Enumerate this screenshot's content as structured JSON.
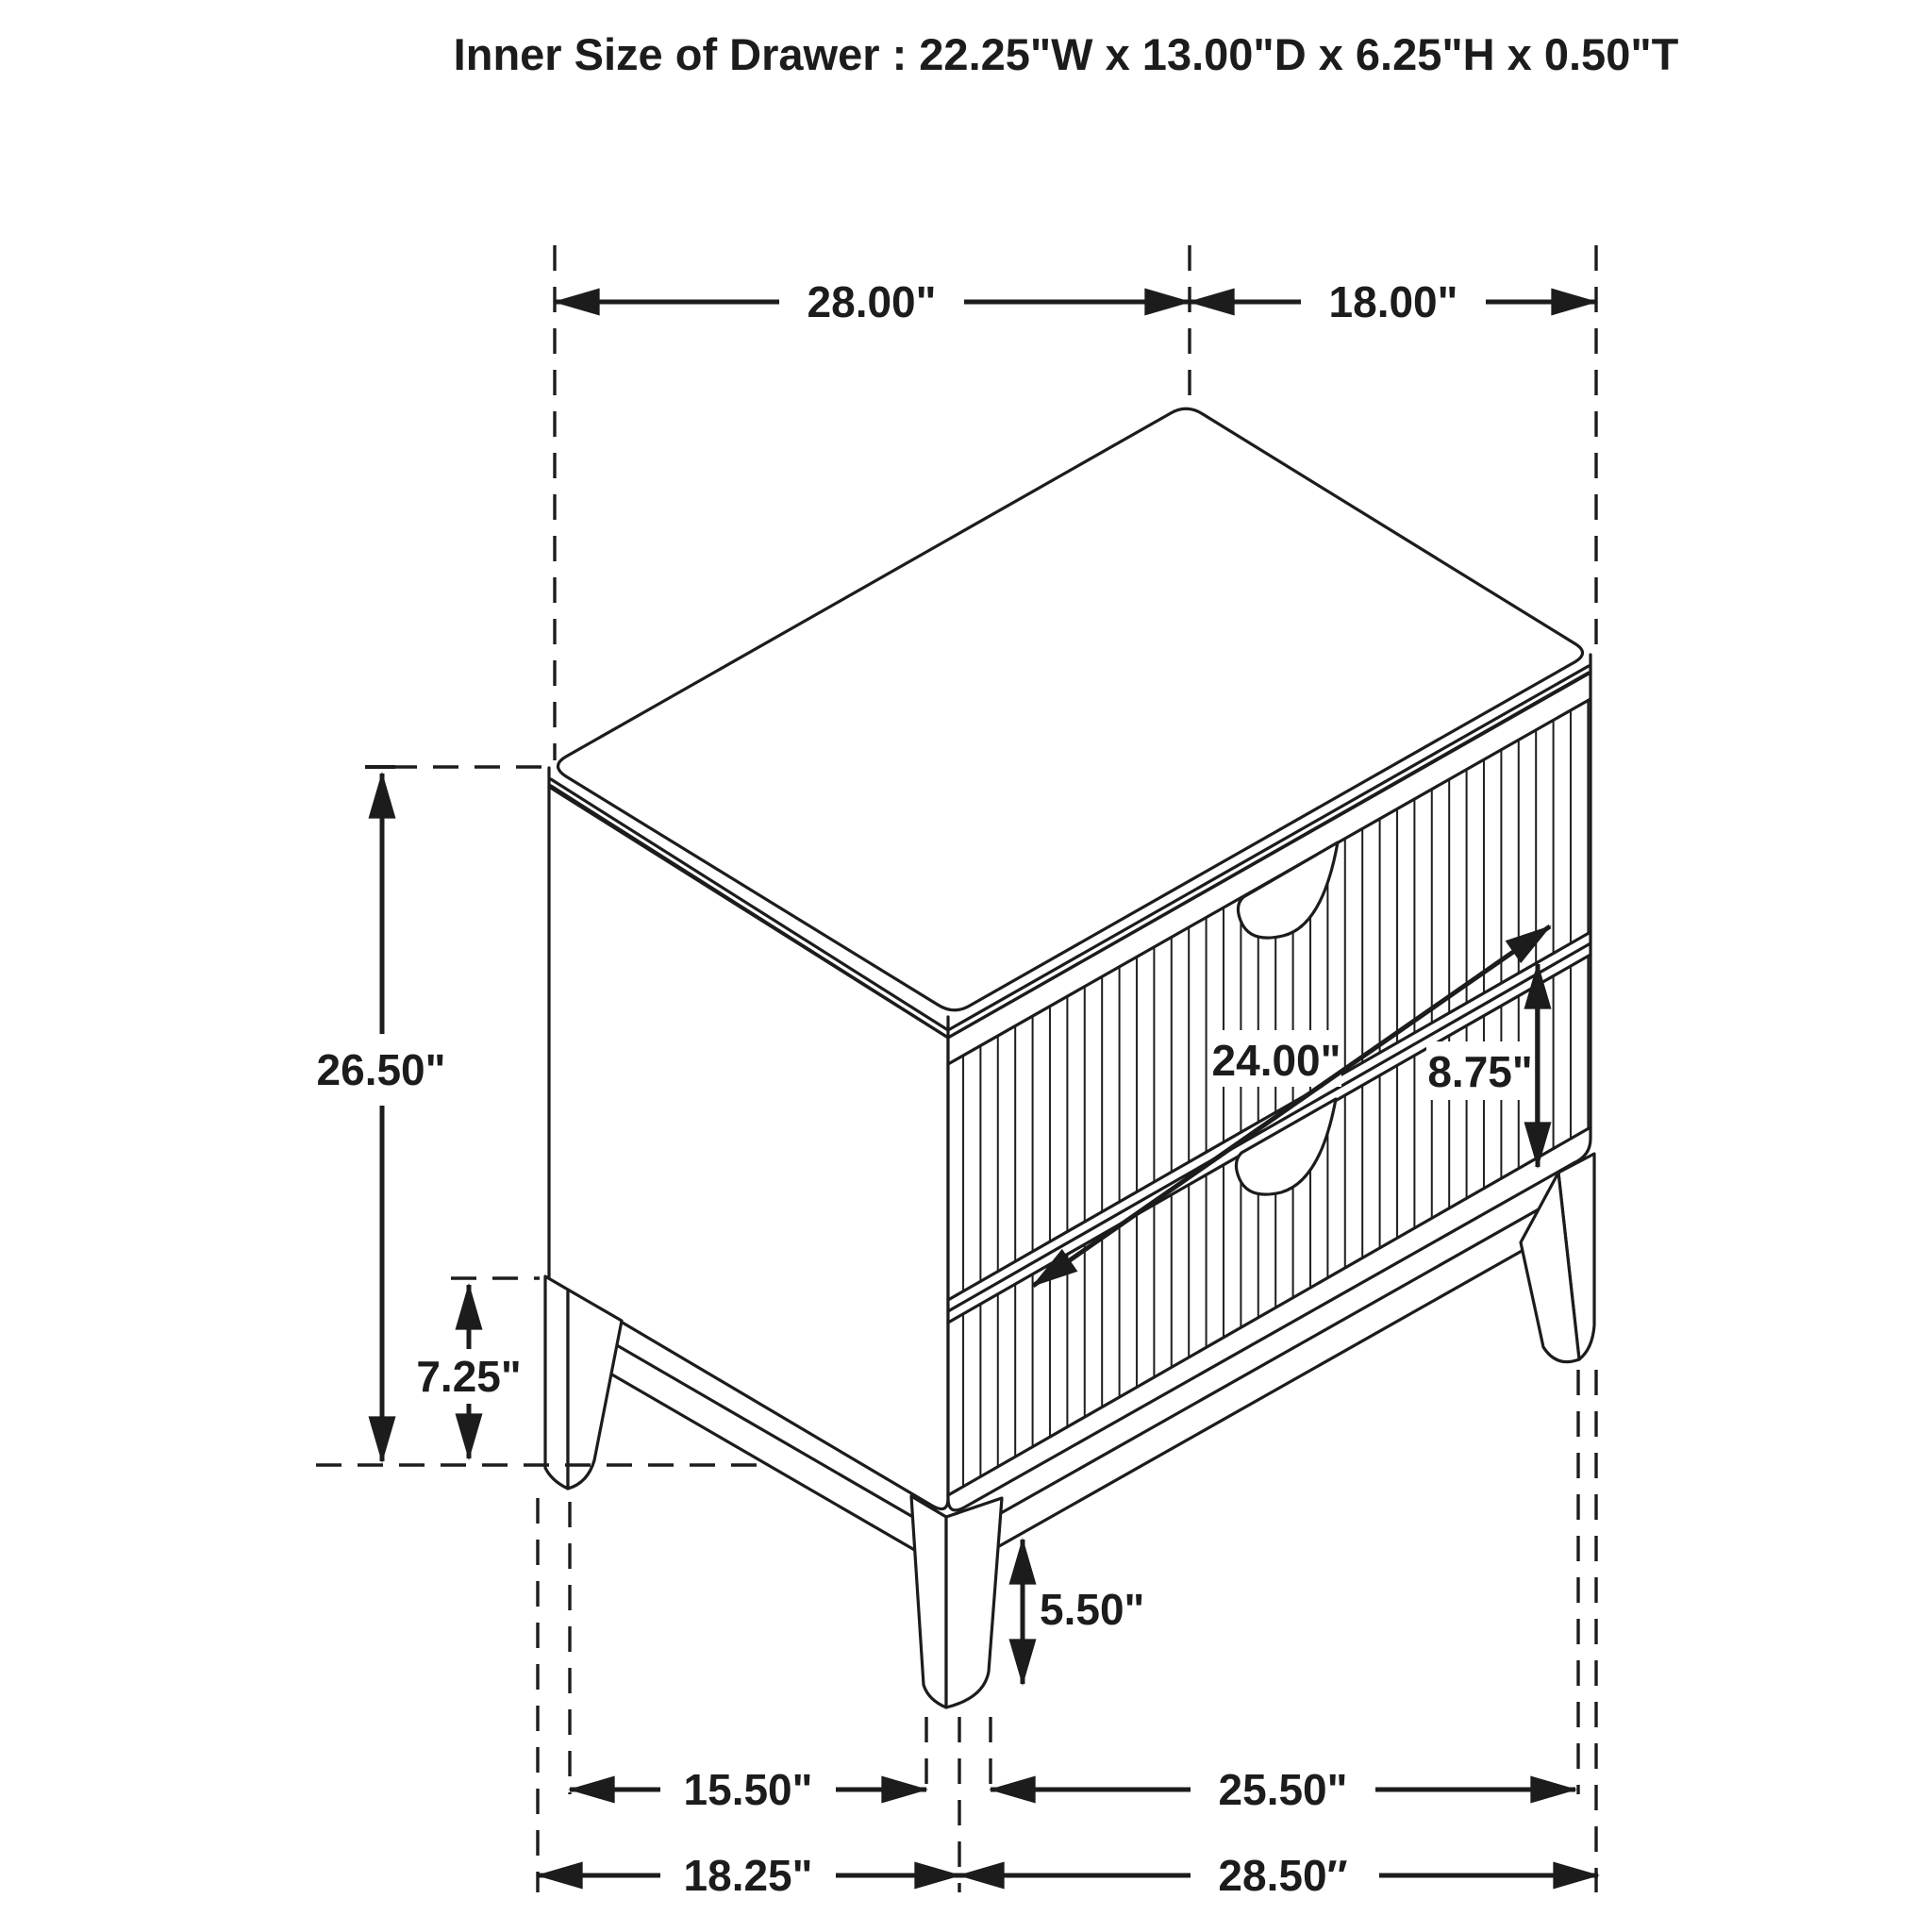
{
  "title": "Inner Size of Drawer : 22.25\"W x 13.00\"D x 6.25\"H x 0.50\"T",
  "drawing": {
    "object": "two-drawer nightstand, isometric technical line drawing",
    "style": "black outline on white, dashed extension lines, arrowed dimension lines"
  },
  "dimensions": {
    "top_width": "28.00\"",
    "top_depth": "18.00\"",
    "overall_height": "26.50\"",
    "side_leg_height": "7.25\"",
    "drawer_width": "24.00\"",
    "drawer_front_height": "8.75\"",
    "front_leg_height": "5.50\"",
    "leg_span_side_inner": "15.50\"",
    "leg_span_front_inner": "25.50\"",
    "leg_span_side_outer": "18.25\"",
    "leg_span_front_outer": "28.50″"
  },
  "colors": {
    "line": "#1c1c1c",
    "background": "#ffffff"
  }
}
